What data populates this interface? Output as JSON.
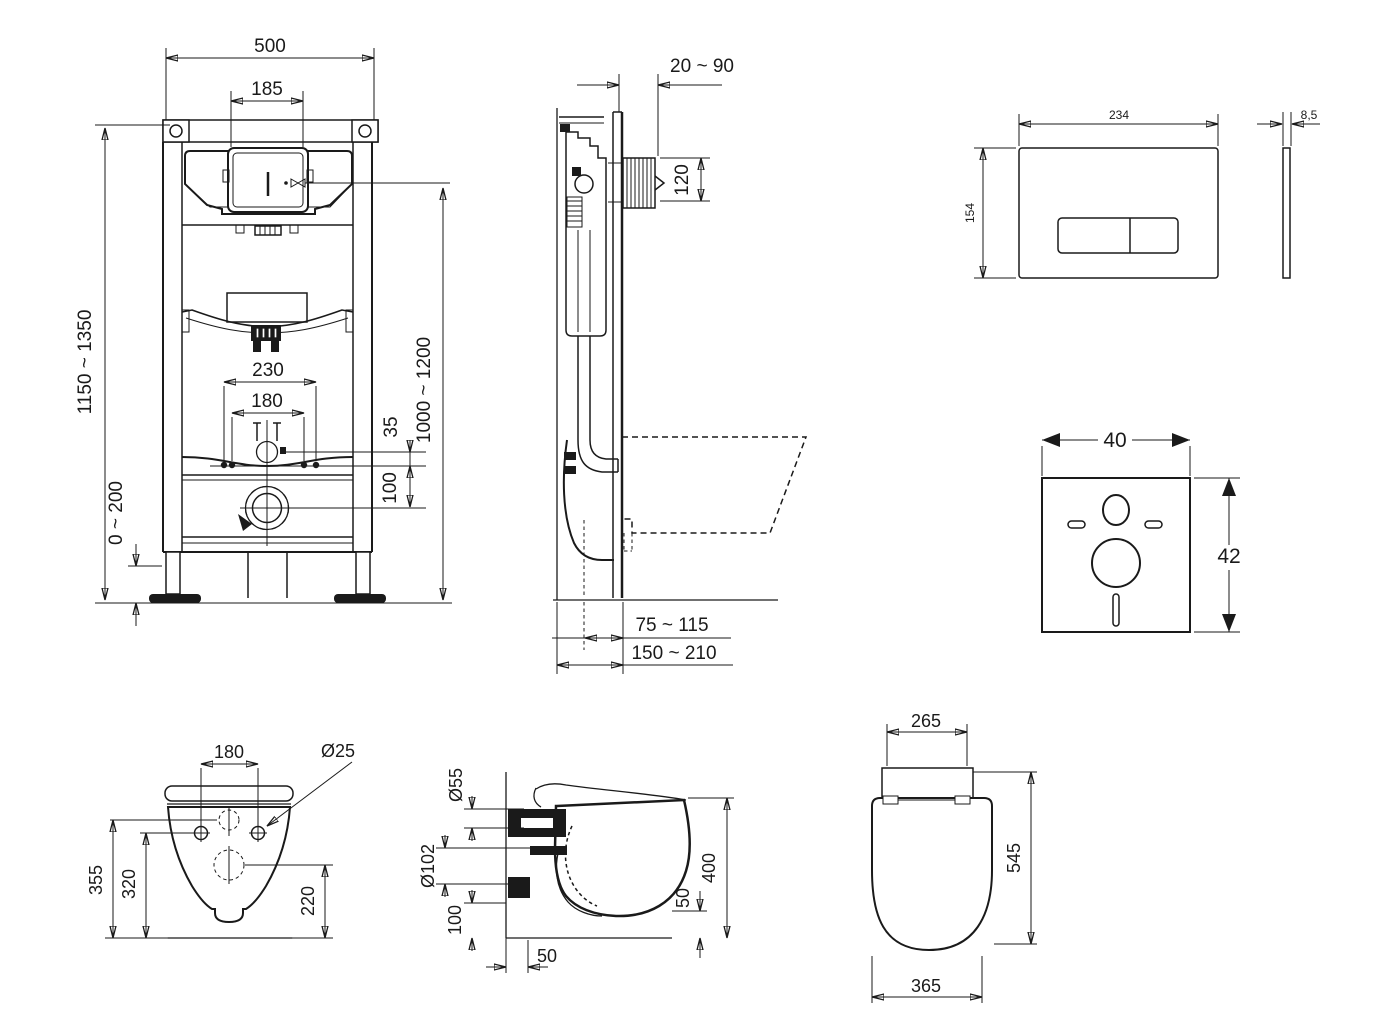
{
  "drawing": {
    "frame_front": {
      "width": "500",
      "cutout_width": "185",
      "height_left": "1150 ~ 1350",
      "height_right": "1000 ~ 1200",
      "pipe_span": "230",
      "bolt_span": "180",
      "inlet_offset": "35",
      "drain_offset": "100",
      "foot_adjust": "0 ~ 200"
    },
    "frame_side": {
      "wall_distance": "20 ~ 90",
      "flush_bend": "120",
      "outlet_depth": "75 ~ 115",
      "frame_depth": "150 ~ 210"
    },
    "flush_plate": {
      "width": "234",
      "height": "154",
      "thickness": "8,5"
    },
    "sound_pad": {
      "width": "40",
      "height": "42"
    },
    "bowl_rear": {
      "bolt_span": "180",
      "bolt_diameter": "Ø25",
      "height_total": "355",
      "height_bolts": "320",
      "height_drain": "220"
    },
    "bowl_side": {
      "inlet_diameter": "Ø55",
      "drain_diameter": "Ø102",
      "drain_height": "100",
      "wall_offset": "50",
      "height": "400",
      "bottom_clearance": "50"
    },
    "seat_top": {
      "tank_width": "265",
      "depth": "545",
      "width": "365"
    }
  }
}
